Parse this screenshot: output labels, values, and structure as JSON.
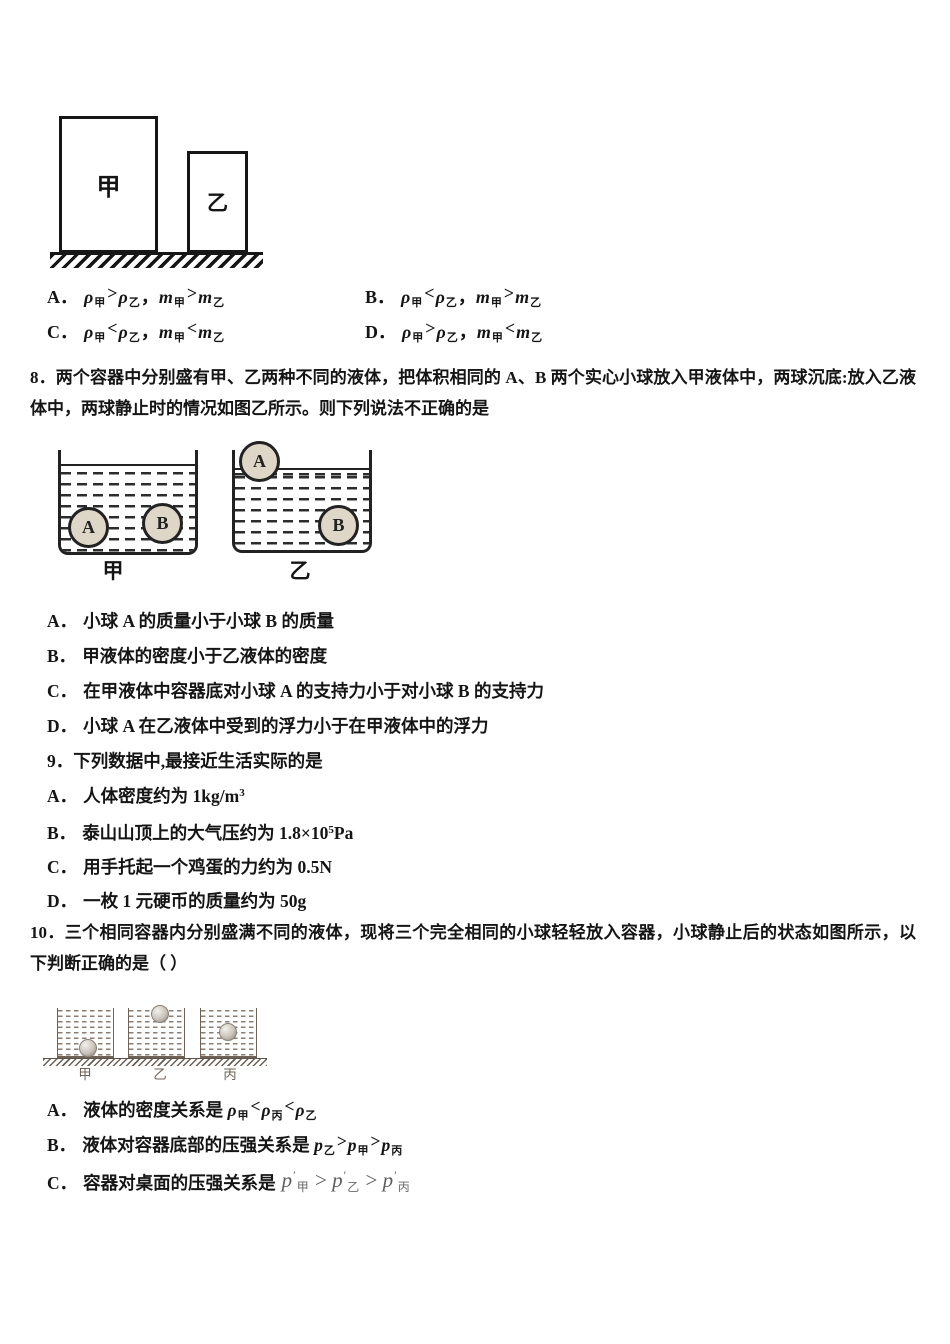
{
  "colors": {
    "text": "#151515",
    "figure_line": "#222222",
    "fig3_line": "#6f6257",
    "fig3_dash": "#8b7d72",
    "equation_gray": "#5c5c5c",
    "ball_fill": "#ded6c6"
  },
  "fig_blocks": {
    "jia": "甲",
    "yi": "乙"
  },
  "q7_options": [
    {
      "label": "A．",
      "formula": [
        {
          "i": "ρ"
        },
        {
          "sub": "甲"
        },
        {
          "cmp": ">"
        },
        {
          "i": "ρ"
        },
        {
          "sub": "乙"
        },
        {
          "t": "，"
        },
        {
          "i": "m"
        },
        {
          "sub": "甲"
        },
        {
          "cmp": ">"
        },
        {
          "i": "m"
        },
        {
          "sub": "乙"
        }
      ]
    },
    {
      "label": "B．",
      "formula": [
        {
          "i": "ρ"
        },
        {
          "sub": "甲"
        },
        {
          "cmp": "<"
        },
        {
          "i": "ρ"
        },
        {
          "sub": "乙"
        },
        {
          "t": "，"
        },
        {
          "i": "m"
        },
        {
          "sub": "甲"
        },
        {
          "cmp": ">"
        },
        {
          "i": "m"
        },
        {
          "sub": "乙"
        }
      ]
    },
    {
      "label": "C．",
      "formula": [
        {
          "i": "ρ"
        },
        {
          "sub": "甲"
        },
        {
          "cmp": "<"
        },
        {
          "i": "ρ"
        },
        {
          "sub": "乙"
        },
        {
          "t": "，"
        },
        {
          "i": "m"
        },
        {
          "sub": "甲"
        },
        {
          "cmp": "<"
        },
        {
          "i": "m"
        },
        {
          "sub": "乙"
        }
      ]
    },
    {
      "label": "D．",
      "formula": [
        {
          "i": "ρ"
        },
        {
          "sub": "甲"
        },
        {
          "cmp": ">"
        },
        {
          "i": "ρ"
        },
        {
          "sub": "乙"
        },
        {
          "t": "，"
        },
        {
          "i": "m"
        },
        {
          "sub": "甲"
        },
        {
          "cmp": "<"
        },
        {
          "i": "m"
        },
        {
          "sub": "乙"
        }
      ]
    }
  ],
  "q8": {
    "line1": "8．两个容器中分别盛有甲、乙两种不同的液体，把体积相同的 A、B 两个实心小球放入甲液体中，两球沉底:放入乙液",
    "line2": "体中，两球静止时的情况如图乙所示。则下列说法不正确的是",
    "figure": {
      "ball_a": "A",
      "ball_b": "B",
      "beaker_jia": "甲",
      "beaker_yi": "乙"
    },
    "options": [
      {
        "label": "A．",
        "text": "小球 A 的质量小于小球 B 的质量"
      },
      {
        "label": "B．",
        "text": "甲液体的密度小于乙液体的密度"
      },
      {
        "label": "C．",
        "text": "在甲液体中容器底对小球 A 的支持力小于对小球 B 的支持力"
      },
      {
        "label": "D．",
        "text": "小球 A 在乙液体中受到的浮力小于在甲液体中的浮力"
      }
    ]
  },
  "q9": {
    "title": "9．下列数据中,最接近生活实际的是",
    "options": [
      {
        "label": "A．",
        "rich": [
          {
            "t": "人体密度约为 1kg/m"
          },
          {
            "sup": "3"
          }
        ]
      },
      {
        "label": "B．",
        "rich": [
          {
            "t": "泰山山顶上的大气压约为 1.8×10"
          },
          {
            "sup": "5"
          },
          {
            "t": "Pa"
          }
        ]
      },
      {
        "label": "C．",
        "rich": [
          {
            "t": "用手托起一个鸡蛋的力约为 0.5N"
          }
        ]
      },
      {
        "label": "D．",
        "rich": [
          {
            "t": "一枚 1 元硬币的质量约为 50g"
          }
        ]
      }
    ]
  },
  "q10": {
    "line1": "10．三个相同容器内分别盛满不同的液体，现将三个完全相同的小球轻轻放入容器，小球静止后的状态如图所示，以",
    "line2": "下判断正确的是（ ）",
    "figure": {
      "jia": "甲",
      "yi": "乙",
      "bing": "丙"
    },
    "options": [
      {
        "label": "A．",
        "pre": "液体的密度关系是 ",
        "rich": [
          {
            "i": "ρ"
          },
          {
            "sub": "甲"
          },
          {
            "cmp": "<"
          },
          {
            "i": "ρ"
          },
          {
            "sub": "丙"
          },
          {
            "cmp": "<"
          },
          {
            "i": "ρ"
          },
          {
            "sub": "乙"
          }
        ]
      },
      {
        "label": "B．",
        "pre": "液体对容器底部的压强关系是 ",
        "rich": [
          {
            "i": "p"
          },
          {
            "sub": "乙"
          },
          {
            "cmp": ">"
          },
          {
            "i": "p"
          },
          {
            "sub": "甲"
          },
          {
            "cmp": ">"
          },
          {
            "i": "p"
          },
          {
            "sub": "丙"
          }
        ]
      },
      {
        "label": "C．",
        "pre": "容器对桌面的压强关系是",
        "eq": [
          {
            "i": "p"
          },
          {
            "pr": "′"
          },
          {
            "sub": "甲"
          },
          {
            "t": " > "
          },
          {
            "i": "p"
          },
          {
            "pr": "′"
          },
          {
            "sub": "乙"
          },
          {
            "t": " > "
          },
          {
            "i": "p"
          },
          {
            "pr": "′"
          },
          {
            "sub": "丙"
          }
        ]
      }
    ]
  }
}
